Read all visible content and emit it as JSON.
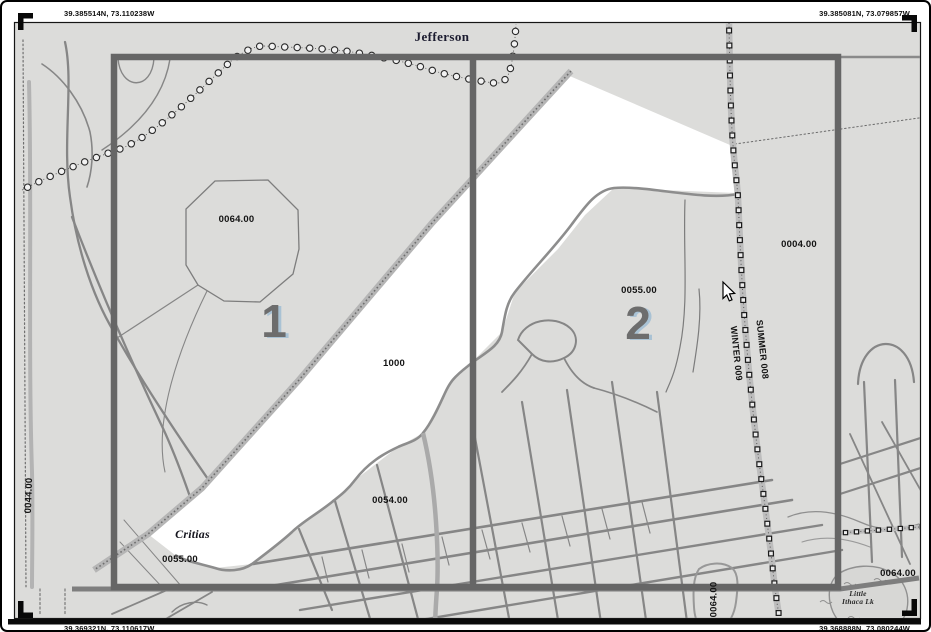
{
  "map_view": {
    "corner_coordinates": {
      "top_left": "39.385514N, 73.110238W",
      "top_right": "39.385081N, 73.079857W",
      "bottom_left": "39.369321N, 73.110617W",
      "bottom_right": "39.368888N, 73.080244W"
    },
    "grid_cells": [
      {
        "label": "1"
      },
      {
        "label": "2"
      }
    ],
    "place_labels": {
      "jefferson": "Jefferson",
      "critias": "Critias",
      "lake_line1": "Little",
      "lake_line2": "Ithaca Lk"
    },
    "road_labels": {
      "summer": "SUMMER 008",
      "winter": "WINTER 009"
    },
    "parcel_labels": {
      "octagon": "0064.00",
      "highlighted": "1000",
      "cell2": "0055.00",
      "east": "0004.00",
      "south_center": "0054.00",
      "southwest": "0055.00",
      "west_edge": "0044.00",
      "bottom_center": "0064.00",
      "southeast": "0064.00"
    },
    "colors": {
      "map_background": "#dcdcda",
      "road_gray": "#868686",
      "grid_frame": "#666666",
      "highlight_parcel": "#ffffff",
      "cell_number": "#6d6d6d",
      "cell_number_shadow": "#a9c2d4"
    }
  }
}
